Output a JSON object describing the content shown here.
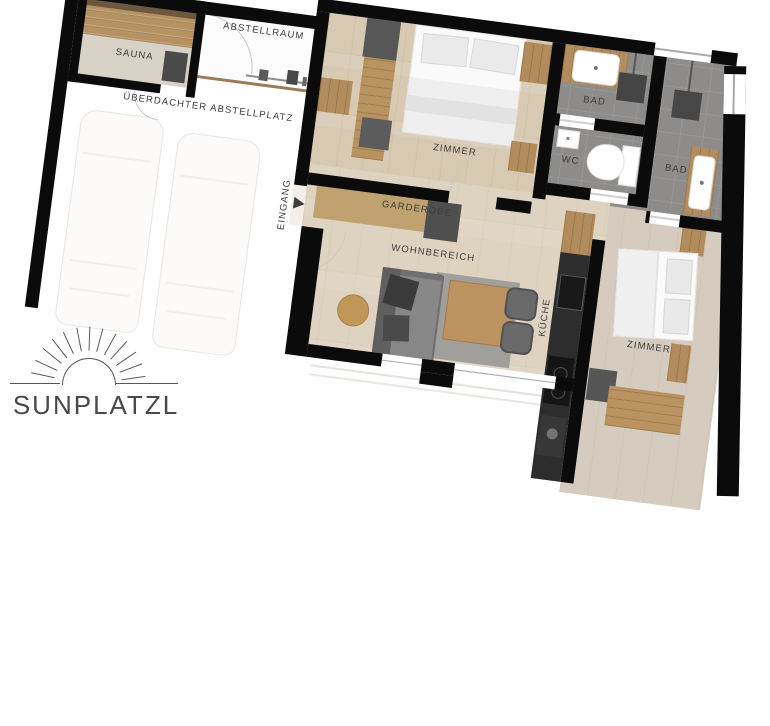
{
  "floorplan": {
    "rooms": {
      "sauna": {
        "label": "SAUNA"
      },
      "abstellraum": {
        "label": "ABSTELLRAUM"
      },
      "carport": {
        "label": "ÜBERDACHTER ABSTELLPLATZ"
      },
      "eingang": {
        "label": "EINGANG"
      },
      "garderobe": {
        "label": "GARDEROBE"
      },
      "wohnbereich": {
        "label": "WOHNBEREICH"
      },
      "kueche": {
        "label": "KÜCHE"
      },
      "zimmer_nord": {
        "label": "ZIMMER"
      },
      "zimmer_sued": {
        "label": "ZIMMER"
      },
      "bad_nord": {
        "label": "BAD"
      },
      "bad_ost": {
        "label": "BAD"
      },
      "wc": {
        "label": "WC"
      }
    },
    "logo": {
      "text": "SUNPLATZL"
    },
    "colors": {
      "wall": "#0b0b0b",
      "wood_floor": "#d7c9b2",
      "tile_floor": "#8d8c8a",
      "oak_furniture": "#b28c5c",
      "label_text": "#3d3d3d",
      "fence_line": "#9b7a55"
    }
  }
}
